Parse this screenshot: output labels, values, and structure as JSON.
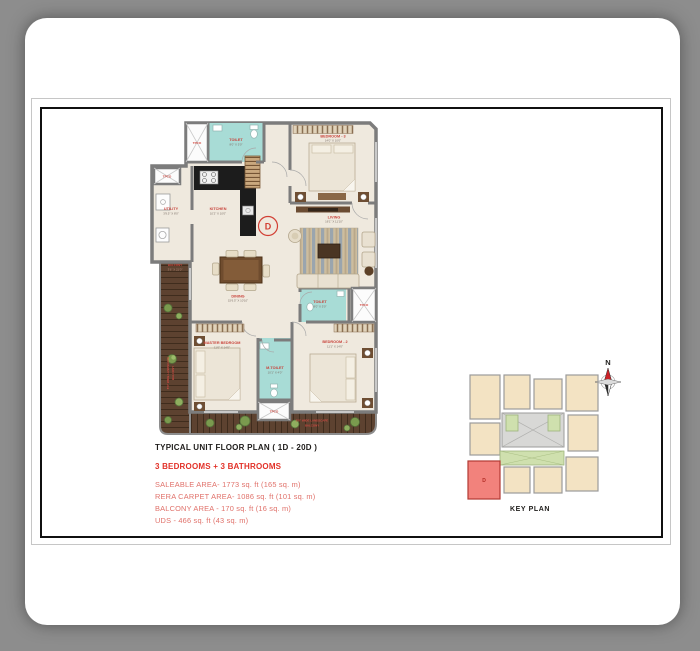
{
  "document": {
    "title": "TYPICAL UNIT FLOOR PLAN ( 1D - 20D )",
    "subtitle": "3 BEDROOMS + 3 BATHROOMS",
    "area_lines": [
      "SALEABLE AREA- 1773 sq. ft (165 sq. m)",
      "RERA CARPET AREA- 1086 sq. ft (101 sq. m)",
      "BALCONY AREA - 170 sq. ft (16 sq. m)",
      "UDS - 466 sq. ft (43 sq. m)"
    ]
  },
  "floor_plan": {
    "unit_marker": "D",
    "shaft_label": "TPCO",
    "rooms": {
      "toilet_top": {
        "name": "TOILET",
        "dim": "8'0\" X 5'0\""
      },
      "bedroom3": {
        "name": "BEDROOM - 3",
        "dim": "14'0\" X 10'0\""
      },
      "utility": {
        "name": "UTILITY",
        "dim": "3'9.5\" X 8'0\""
      },
      "kitchen": {
        "name": "KITCHEN",
        "dim": "10'2\" X 10'0\""
      },
      "living": {
        "name": "LIVING",
        "dim": "16'1\" X 11'10\""
      },
      "dining": {
        "name": "DINING",
        "dim": "15'6.5\" X 10'10\""
      },
      "toilet_mid": {
        "name": "TOILET",
        "dim": "8'0\" X 5'0\""
      },
      "master_bedroom": {
        "name": "MASTER BEDROOM",
        "dim": "11'0\" X 14'0\""
      },
      "m_toilet": {
        "name": "M.TOILET",
        "dim": "10'1\" X 4'0\""
      },
      "bedroom2": {
        "name": "BEDROOM - 2",
        "dim": "11'1\" X 14'0\""
      },
      "balcony": {
        "name": "BALCONY",
        "dim": "3'6\" X 21'0\""
      }
    },
    "balcony_note_line1": "5'0\" WIDE LANDSCAPE",
    "balcony_note_line2": "BALCONY"
  },
  "key_plan": {
    "label": "KEY PLAN",
    "north_label": "N",
    "highlighted_unit": "D"
  },
  "colors": {
    "accent_red": "#e23128",
    "area_text_red": "#e0716a",
    "plan_label_red": "#c8423a",
    "toilet_teal": "#a8dcd6",
    "balcony_wood": "#5d4230",
    "wall_gray": "#7c7c7c",
    "floor_cream": "#efe9de",
    "key_unit_highlight": "#f2827c"
  }
}
